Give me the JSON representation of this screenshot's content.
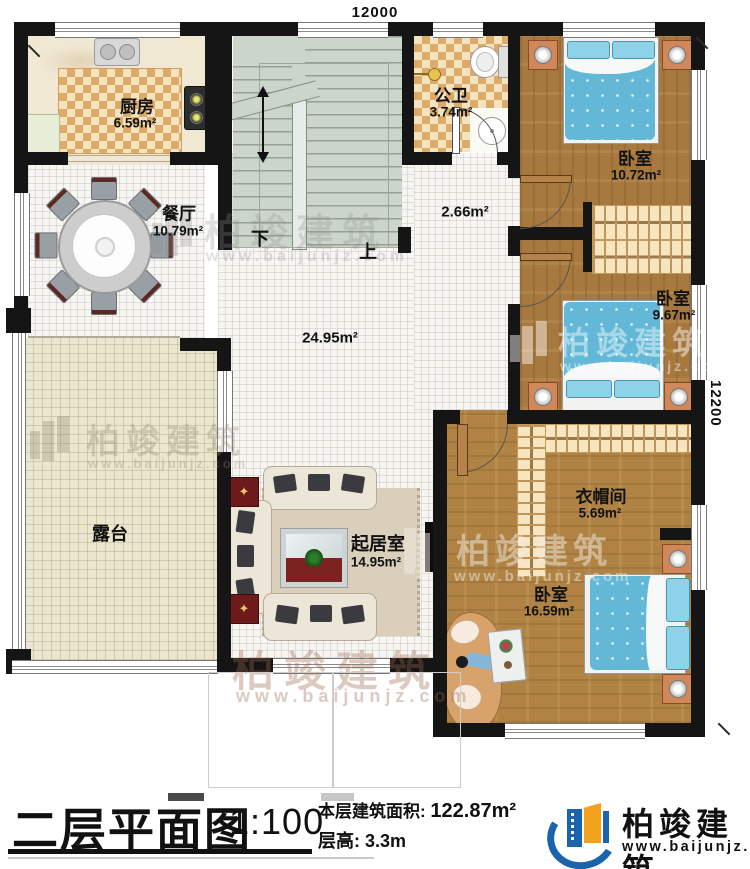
{
  "dimensions": {
    "top": "12000",
    "right": "12200"
  },
  "rooms": {
    "kitchen": {
      "name": "厨房",
      "area": "6.59m²"
    },
    "dining": {
      "name": "餐厅",
      "area": "10.79m²"
    },
    "bathroom": {
      "name": "公卫",
      "area": "3.74m²"
    },
    "bedroom1": {
      "name": "卧室",
      "area": "10.72m²"
    },
    "bedroom2": {
      "name": "卧室",
      "area": "9.67m²"
    },
    "bedroom3": {
      "name": "卧室",
      "area": "16.59m²"
    },
    "cloakroom": {
      "name": "衣帽间",
      "area": "5.69m²"
    },
    "living": {
      "name": "起居室",
      "area": "14.95m²"
    },
    "terrace": {
      "name": "露台"
    },
    "hall": {
      "area": "24.95m²"
    },
    "corridor": {
      "area": "2.66m²"
    }
  },
  "stairs": {
    "down_label": "下",
    "up_label": "上"
  },
  "watermark": {
    "brand": "柏竣建筑",
    "url": "www.baijunjz.com"
  },
  "footer": {
    "title": "二层平面图",
    "scale": "1:100",
    "area_label": "本层建筑面积:",
    "area_value": "122.87m²",
    "height_label": "层高:",
    "height_value": "3.3m",
    "brand": "柏竣建筑",
    "brand_url": "www.baijunjz.com"
  },
  "colors": {
    "wall": "#151515",
    "accent_blue": "#1a63ad",
    "accent_orange": "#f2a11d",
    "bed_blue": "#62b8d6"
  }
}
